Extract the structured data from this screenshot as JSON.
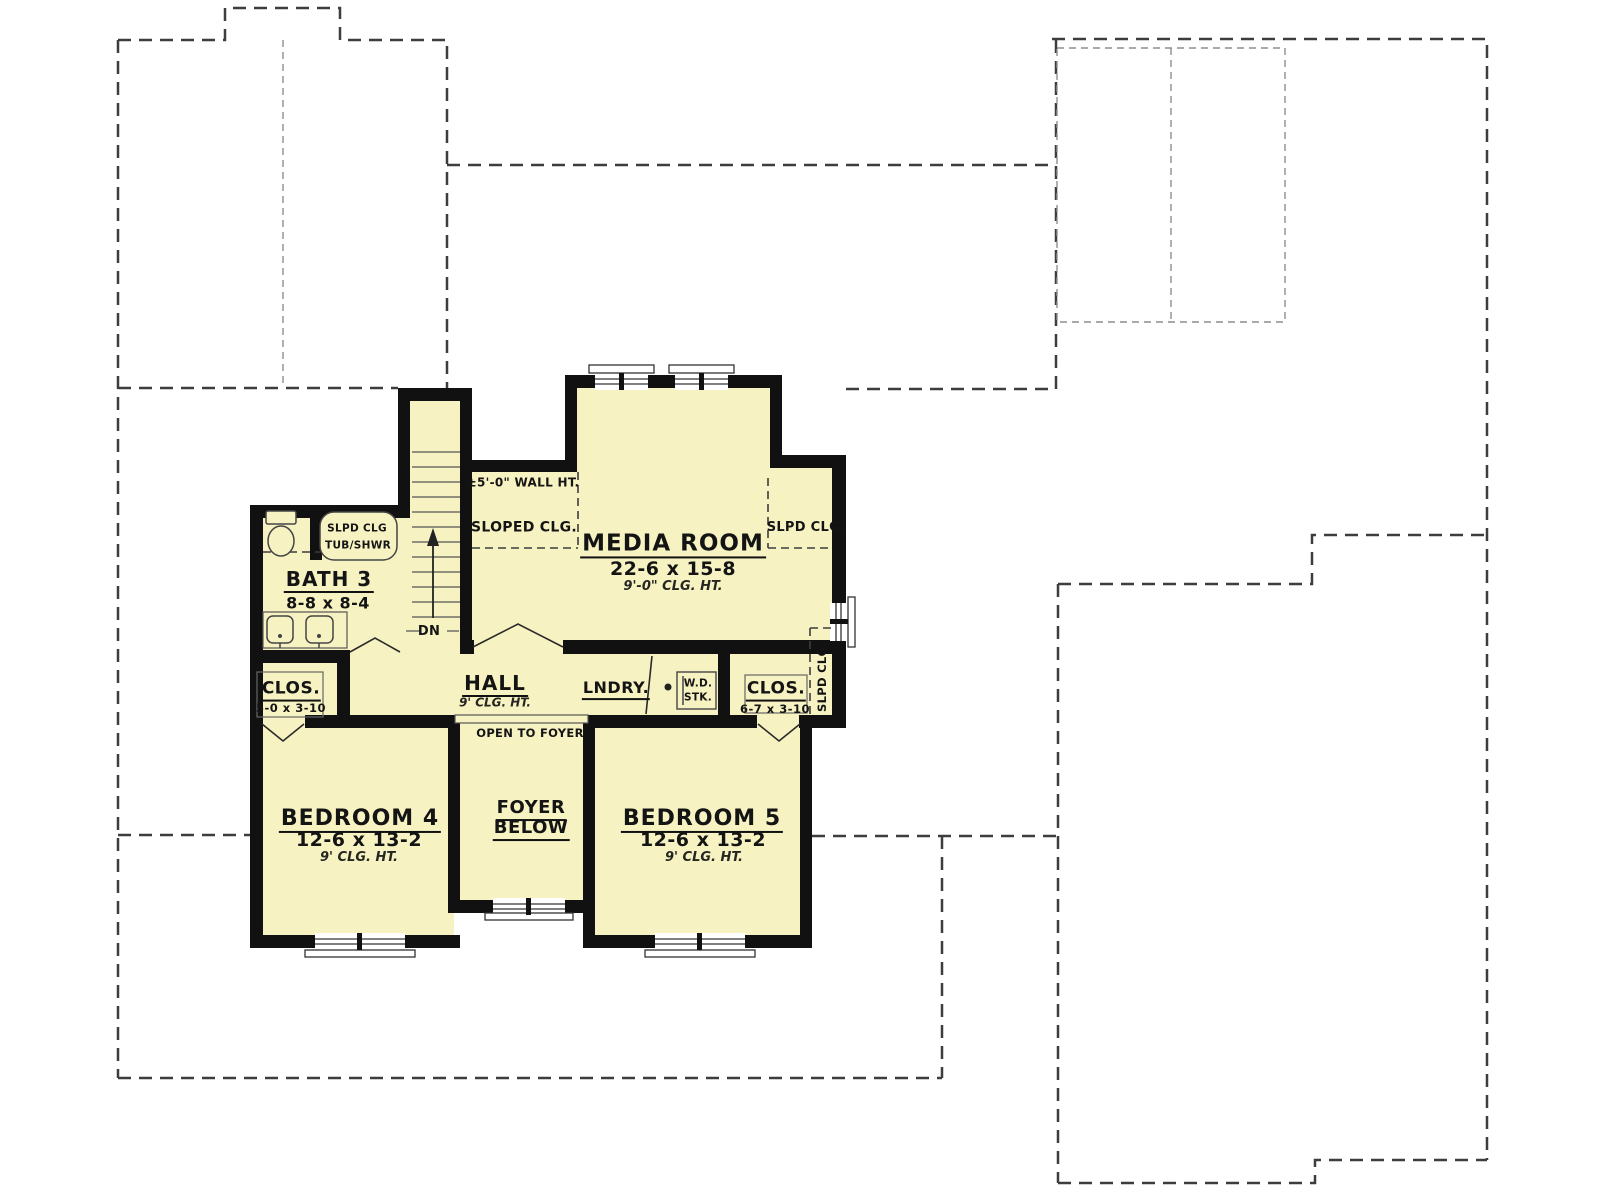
{
  "rooms": {
    "media_room": {
      "name": "MEDIA ROOM",
      "dims": "22-6 x 15-8",
      "clg": "9'-0\" CLG. HT."
    },
    "bath3": {
      "name": "BATH 3",
      "dims": "8-8 x 8-4"
    },
    "hall": {
      "name": "HALL",
      "clg": "9' CLG. HT."
    },
    "closet_left": {
      "name": "CLOS.",
      "dims": "5-0 x 3-10"
    },
    "closet_right": {
      "name": "CLOS.",
      "dims": "6-7 x 3-10"
    },
    "laundry": {
      "name": "LNDRY."
    },
    "bedroom4": {
      "name": "BEDROOM 4",
      "dims": "12-6 x 13-2",
      "clg": "9' CLG. HT."
    },
    "bedroom5": {
      "name": "BEDROOM 5",
      "dims": "12-6 x 13-2",
      "clg": "9' CLG. HT."
    },
    "foyer_below": {
      "line1": "FOYER",
      "line2": "BELOW"
    }
  },
  "annotations": {
    "wall_height": "±5'-0\" WALL HT.",
    "sloped_clg": "SLOPED CLG.",
    "slpd_clg_right": "SLPD CLG.",
    "slpd_clg_vertical": "SLPD CLG.",
    "tub_slpd": "SLPD CLG",
    "tub_shwr": "TUB/SHWR",
    "wd": "W.D.",
    "stk": "STK.",
    "open_to_foyer": "OPEN TO FOYER",
    "down": "DN"
  },
  "colors": {
    "room_fill": "#f6f2c2",
    "wall": "#111111",
    "roof_dash": "#3d3d3d",
    "paper": "#ffffff"
  }
}
